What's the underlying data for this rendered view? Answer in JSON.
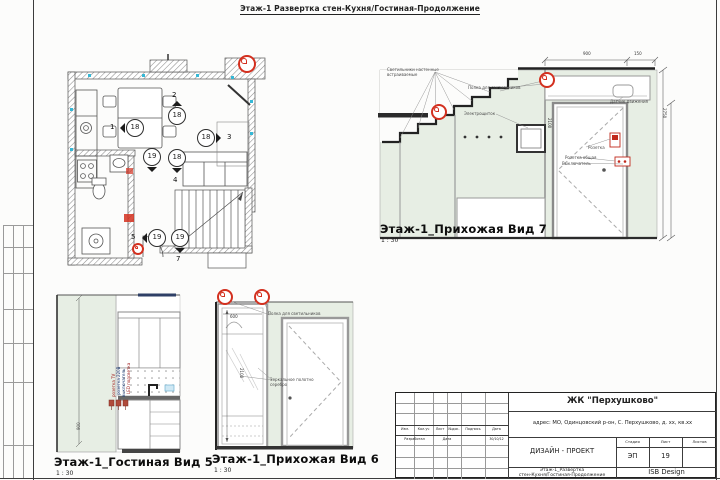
{
  "sheet": {
    "top_title": "Этаж-1  Развертка стен-Кухня/Гостиная-Продолжение"
  },
  "plan": {
    "view_markers": [
      {
        "n": "18",
        "cx": 135,
        "cy": 128,
        "dir": "left",
        "tag": "1",
        "tx": 110,
        "ty": 124
      },
      {
        "n": "18",
        "cx": 177,
        "cy": 116,
        "dir": "up",
        "tag": "2",
        "tx": 172,
        "ty": 92
      },
      {
        "n": "18",
        "cx": 206,
        "cy": 138,
        "dir": "right",
        "tag": "3",
        "tx": 227,
        "ty": 134
      },
      {
        "n": "18",
        "cx": 177,
        "cy": 158,
        "dir": "down",
        "tag": "4",
        "tx": 173,
        "ty": 177
      },
      {
        "n": "19",
        "cx": 152,
        "cy": 157,
        "dir": "down",
        "tag": ""
      },
      {
        "n": "19",
        "cx": 157,
        "cy": 238,
        "dir": "left",
        "tag": "5",
        "tx": 131,
        "ty": 234
      },
      {
        "n": "19",
        "cx": 180,
        "cy": 238,
        "dir": "down",
        "tag": "7",
        "tx": 176,
        "ty": 256
      }
    ],
    "lamps": [
      {
        "x": 247,
        "y": 64,
        "r": 9
      },
      {
        "x": 138,
        "y": 249,
        "r": 6
      }
    ]
  },
  "view7": {
    "label": "Этаж-1_Прихожая Вид 7",
    "scale": "1 : 30",
    "lamps": [
      {
        "x": 439,
        "y": 112,
        "r": 8
      },
      {
        "x": 547,
        "y": 80,
        "r": 8
      }
    ],
    "annotations": [
      {
        "text": "Светильники настенные",
        "x": 387,
        "y": 68
      },
      {
        "text": "встраиваемые",
        "x": 387,
        "y": 73
      },
      {
        "text": "Полка для светильников",
        "x": 468,
        "y": 86
      },
      {
        "text": "Электрощиток",
        "x": 464,
        "y": 112
      },
      {
        "text": "Датчик движения",
        "x": 610,
        "y": 100
      },
      {
        "text": "Розетка",
        "x": 588,
        "y": 146
      },
      {
        "text": "Розетка общая",
        "x": 565,
        "y": 156
      },
      {
        "text": "Выключатель",
        "x": 562,
        "y": 162
      }
    ],
    "dims": [
      {
        "text": "900",
        "x": 583,
        "y": 52
      },
      {
        "text": "150",
        "x": 634,
        "y": 52
      },
      {
        "text": "2750",
        "x": 666,
        "y": 108,
        "rot": 90
      },
      {
        "text": "2100",
        "x": 551,
        "y": 118,
        "rot": 90
      }
    ]
  },
  "view5": {
    "label": "Этаж-1_Гостиная Вид 5",
    "scale": "1 : 30",
    "annotations": [
      {
        "text": "розетка TV",
        "x": 112,
        "y": 397,
        "rot": -90,
        "color": "#a02020"
      },
      {
        "text": "розетка 220В",
        "x": 117,
        "y": 395,
        "rot": -90,
        "color": "#1f3f7a"
      },
      {
        "text": "выключатель",
        "x": 122,
        "y": 397,
        "rot": -90,
        "color": "#1f3f7a"
      },
      {
        "text": "LED подсветка",
        "x": 127,
        "y": 394,
        "rot": -90,
        "color": "#a02020"
      },
      {
        "text": "900",
        "x": 77,
        "y": 430,
        "rot": -90,
        "color": "#444444"
      }
    ]
  },
  "view6": {
    "label": "Этаж-1_Прихожая Вид 6",
    "scale": "1 : 30",
    "lamps": [
      {
        "x": 225,
        "y": 297,
        "r": 8
      },
      {
        "x": 262,
        "y": 297,
        "r": 8
      }
    ],
    "annotations": [
      {
        "text": "Полка для светильников",
        "x": 268,
        "y": 312
      },
      {
        "text": "Зеркальное полотно",
        "x": 270,
        "y": 378
      },
      {
        "text": "серебро",
        "x": 270,
        "y": 383
      }
    ],
    "dims": [
      {
        "text": "600",
        "x": 230,
        "y": 315
      },
      {
        "text": "2100",
        "x": 243,
        "y": 368,
        "rot": 90
      }
    ]
  },
  "titleblock": {
    "project": "ЖК \"Перхушково\"",
    "address": "адрес: МО, Одинцовский р-он, С. Перхушково, д. хх, кв.хх",
    "doc_type": "ДИЗАЙН - ПРОЕКТ",
    "stage_label": "Стадия",
    "sheet_label": "Лист",
    "sheets_label": "Листов",
    "stage": "ЭП",
    "sheet_no": "19",
    "sheets_total": "",
    "title_line1": "Этаж-1_Развертка",
    "title_line2": "стен-Кухня/Гостиная-Продолжение",
    "company": "ISB Design",
    "cols": [
      "Изм.",
      "Кол.уч",
      "Лист",
      "№док.",
      "Подпись",
      "Дата"
    ],
    "dev_label": "Разработал",
    "date_label": "Дата",
    "date_value": "30/10/12"
  }
}
